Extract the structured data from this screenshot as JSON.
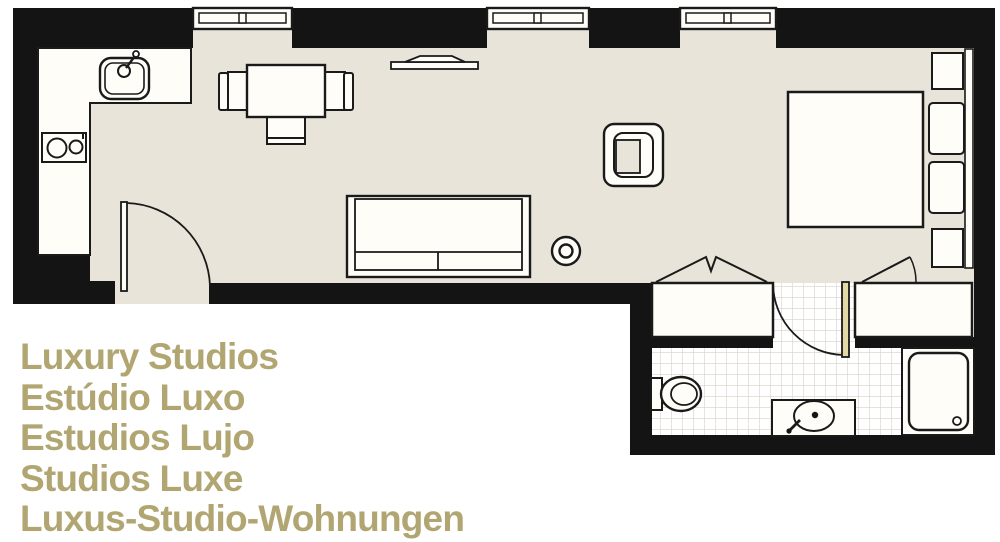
{
  "caption": {
    "line1": "Luxury Studios",
    "line2": "Estúdio Luxo",
    "line3": "Estudios Lujo",
    "line4": "Studios Luxe",
    "line5": "Luxus-Studio-Wohnungen"
  },
  "colors": {
    "caption_olive": "#b1a671",
    "wall_black": "#141414",
    "floor_beige": "#e8e4d9",
    "bath_door_tan": "#e3d9a5",
    "tile_grid_line": "#d6d2c5",
    "fixture_white": "#fffdf8",
    "outline_black": "#1a1a1a"
  },
  "symbols": [
    "window",
    "kitchen-sink",
    "stove-two-burner",
    "dining-table",
    "dining-chair",
    "tv-shelf",
    "sofa",
    "side-table",
    "armchair",
    "entry-door",
    "double-bed",
    "pillow",
    "nightstand",
    "headboard",
    "wardrobe-folding-door",
    "wardrobe-hinged-door",
    "bathroom-door",
    "toilet",
    "washbasin-vanity",
    "shower"
  ]
}
